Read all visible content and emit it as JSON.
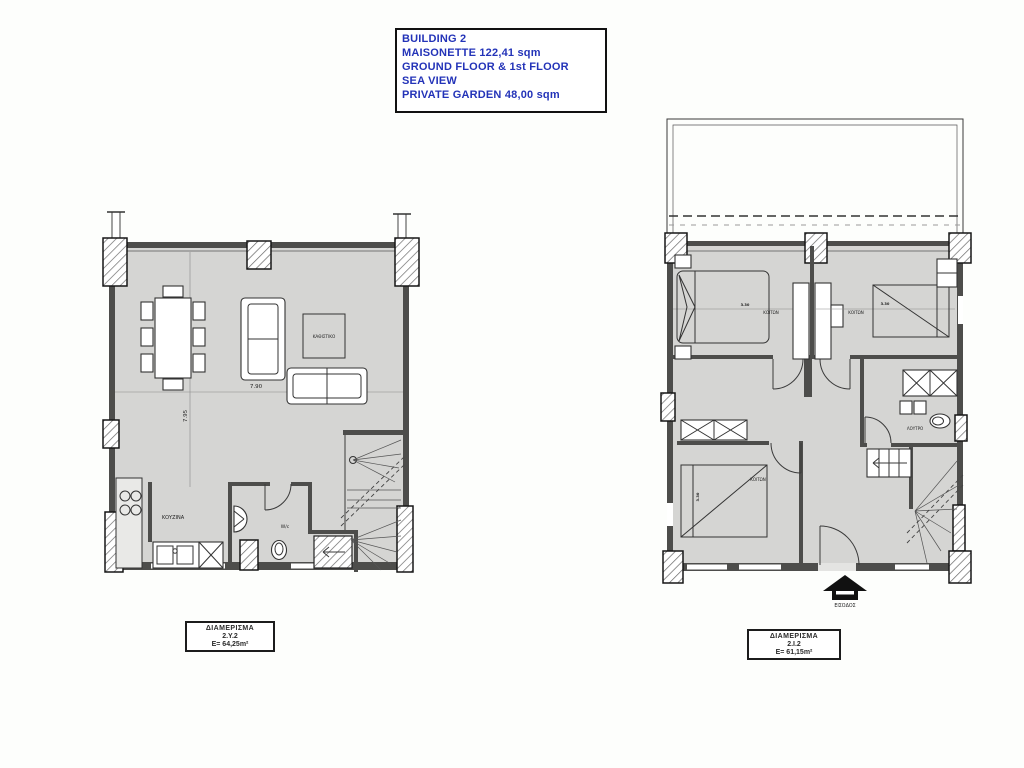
{
  "title_block": {
    "lines": [
      "BUILDING 2",
      "MAISONETTE 122,41 sqm",
      "GROUND FLOOR & 1st FLOOR",
      "SEA VIEW",
      "PRIVATE GARDEN 48,00 sqm"
    ]
  },
  "ground_floor": {
    "rooms": {
      "living": "ΚΑΘΙΣΤΙΚΟ",
      "kitchen": "ΚΟΥΖΙΝΑ",
      "wc": "W/c"
    },
    "dims": {
      "width": "7.90",
      "height": "7.95"
    },
    "label_box": {
      "title": "ΔΙΑΜΕΡΙΣΜΑ",
      "code": "2.Υ.2",
      "area": "E= 64,25m²"
    }
  },
  "first_floor": {
    "rooms": {
      "bedroom1": "ΚΟΙΤΩΝ",
      "bedroom2": "ΚΟΙΤΩΝ",
      "bedroom3": "ΚΟΙΤΩΝ",
      "bathroom": "ΛΟΥΤΡΟ"
    },
    "entrance": "ΕΙΣΟΔΟΣ",
    "dims": {
      "bed1": "3.30",
      "bed2": "3.30",
      "bed3": "3.30"
    },
    "label_box": {
      "title": "ΔΙΑΜΕΡΙΣΜΑ",
      "code": "2.Ι.2",
      "area": "E= 61,15m²"
    }
  },
  "colors": {
    "floor": "#d5d5d3",
    "wall": "#4d4d4b",
    "title_text": "#2333b8",
    "background": "#fdfefc"
  }
}
